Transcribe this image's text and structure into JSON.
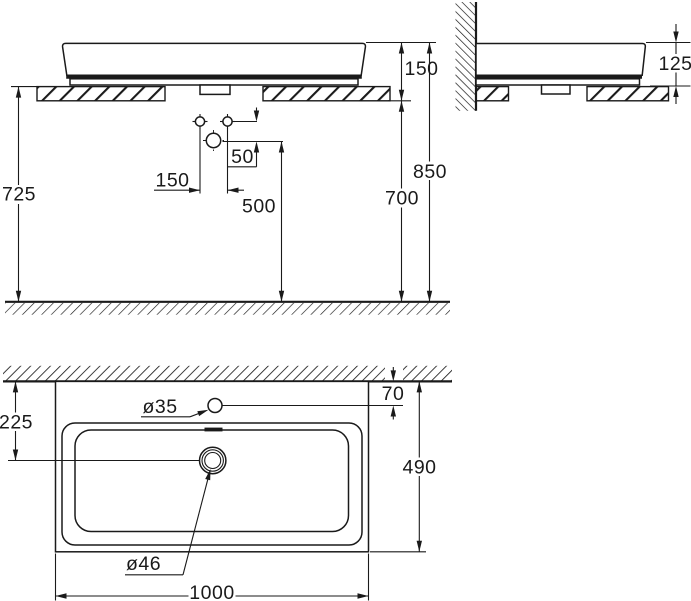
{
  "drawing": {
    "ink_color": "#1a1a1a",
    "background_color": "#ffffff",
    "front_view": {
      "dim_counter_top_to_floor": "725",
      "dim_basin_top_to_counter_bottom": "150",
      "dim_total_height": "850",
      "dim_counter_bottom_to_floor": "700",
      "dim_drain_center_to_floor": "500",
      "dim_holes_to_drain_offset": "50",
      "dim_fixing_holes_spacing": "150"
    },
    "side_view": {
      "dim_basin_height": "125"
    },
    "top_view": {
      "label_faucet_hole": "ø35",
      "label_drain_hole": "ø46",
      "dim_faucet_hole_from_wall": "70",
      "dim_drain_center_from_wall": "225",
      "dim_basin_depth": "490",
      "dim_basin_width": "1000"
    }
  }
}
